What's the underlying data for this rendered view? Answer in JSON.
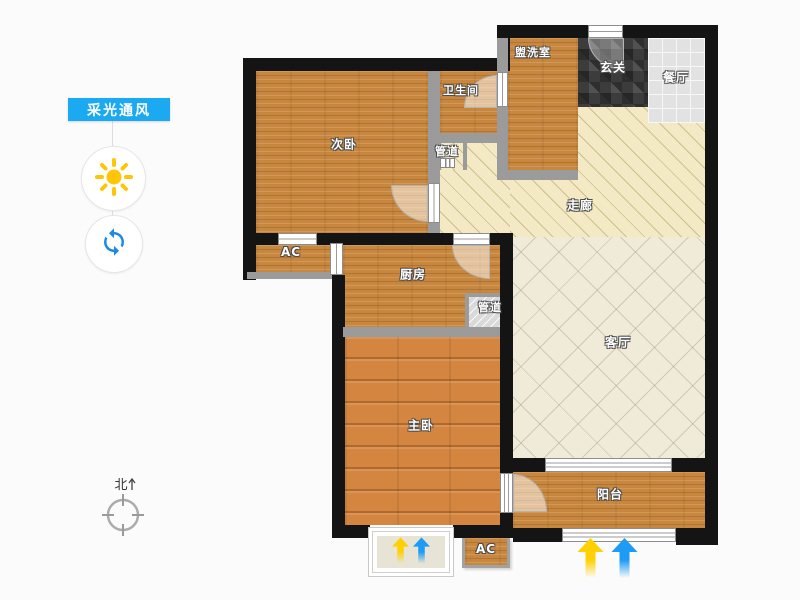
{
  "sidebar": {
    "button_label": "采光通风",
    "tools": [
      {
        "id": "daylight",
        "icon": "sun-icon"
      },
      {
        "id": "ventilation",
        "icon": "sync-rotate-icon"
      }
    ]
  },
  "compass": {
    "north_label": "北"
  },
  "floorplan": {
    "rooms": [
      {
        "id": "bedroom2",
        "label": "次卧"
      },
      {
        "id": "bathroom",
        "label": "卫生间"
      },
      {
        "id": "duct-upper",
        "label": "管道"
      },
      {
        "id": "washroom",
        "label": "盥洗室"
      },
      {
        "id": "foyer",
        "label": "玄关"
      },
      {
        "id": "dining",
        "label": "餐厅"
      },
      {
        "id": "corridor",
        "label": "走廊"
      },
      {
        "id": "ac-upper",
        "label": "AC"
      },
      {
        "id": "kitchen",
        "label": "厨房"
      },
      {
        "id": "duct-kitchen",
        "label": "管道"
      },
      {
        "id": "living",
        "label": "客厅"
      },
      {
        "id": "master",
        "label": "主卧"
      },
      {
        "id": "balcony",
        "label": "阳台"
      },
      {
        "id": "ac-lower",
        "label": "AC"
      }
    ]
  },
  "indicators": {
    "daylight_arrow_color": "#ffd103",
    "ventilation_arrow_color": "#1d9bf5"
  },
  "colors": {
    "accent_blue": "#1ba9f1",
    "sun_yellow": "#ffc608",
    "sync_blue": "#1e88e5",
    "wall_black": "#141414",
    "wall_gray": "#9b9b9b",
    "wood_mid": "#c8873f",
    "wood_bright": "#d48540",
    "foyer_mosaic": "#3c3c3c",
    "dining_tile": "#e2e2e2",
    "corridor_cream": "#f3e9c5",
    "living_marble": "#f0ead9",
    "background": "#fbfbfb"
  }
}
